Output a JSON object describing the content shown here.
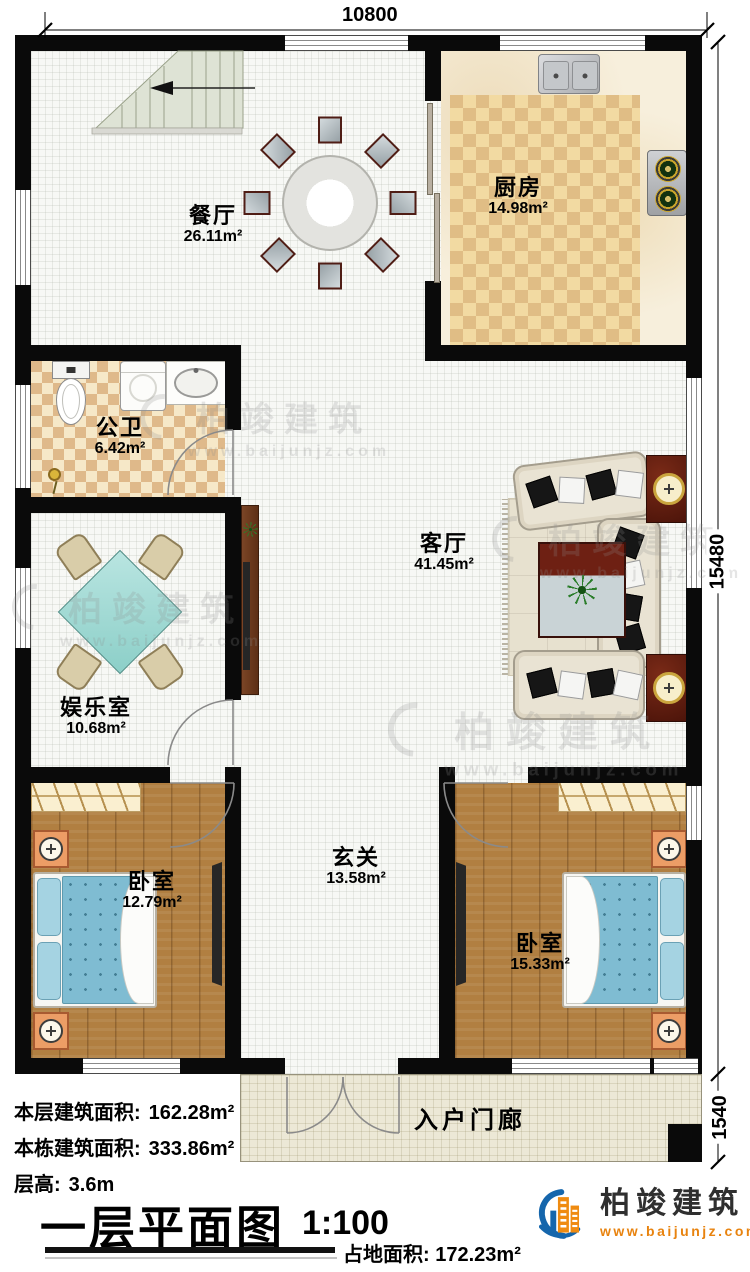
{
  "dims": {
    "top": "10800",
    "right": "15480",
    "right_small": "1540"
  },
  "rooms": [
    {
      "name": "餐厅",
      "area": "26.11m²"
    },
    {
      "name": "厨房",
      "area": "14.98m²"
    },
    {
      "name": "公卫",
      "area": "6.42m²"
    },
    {
      "name": "客厅",
      "area": "41.45m²"
    },
    {
      "name": "娱乐室",
      "area": "10.68m²"
    },
    {
      "name": "卧室",
      "area": "12.79m²"
    },
    {
      "name": "玄关",
      "area": "13.58m²"
    },
    {
      "name": "卧室",
      "area": "15.33m²"
    },
    {
      "name": "入户门廊",
      "area": ""
    }
  ],
  "stats": [
    {
      "label": "本层建筑面积:",
      "value": "162.28m²"
    },
    {
      "label": "本栋建筑面积:",
      "value": "333.86m²"
    },
    {
      "label": "层高:",
      "value": "3.6m"
    }
  ],
  "footer": {
    "title": "一层平面图",
    "scale": "1:100",
    "land_label": "占地面积:",
    "land_value": "172.23m²"
  },
  "brand": {
    "name": "柏竣建筑",
    "url": "www.baijunjz.com"
  },
  "watermark": {
    "name": "柏竣建筑",
    "url": "www.baijunjz.com"
  }
}
